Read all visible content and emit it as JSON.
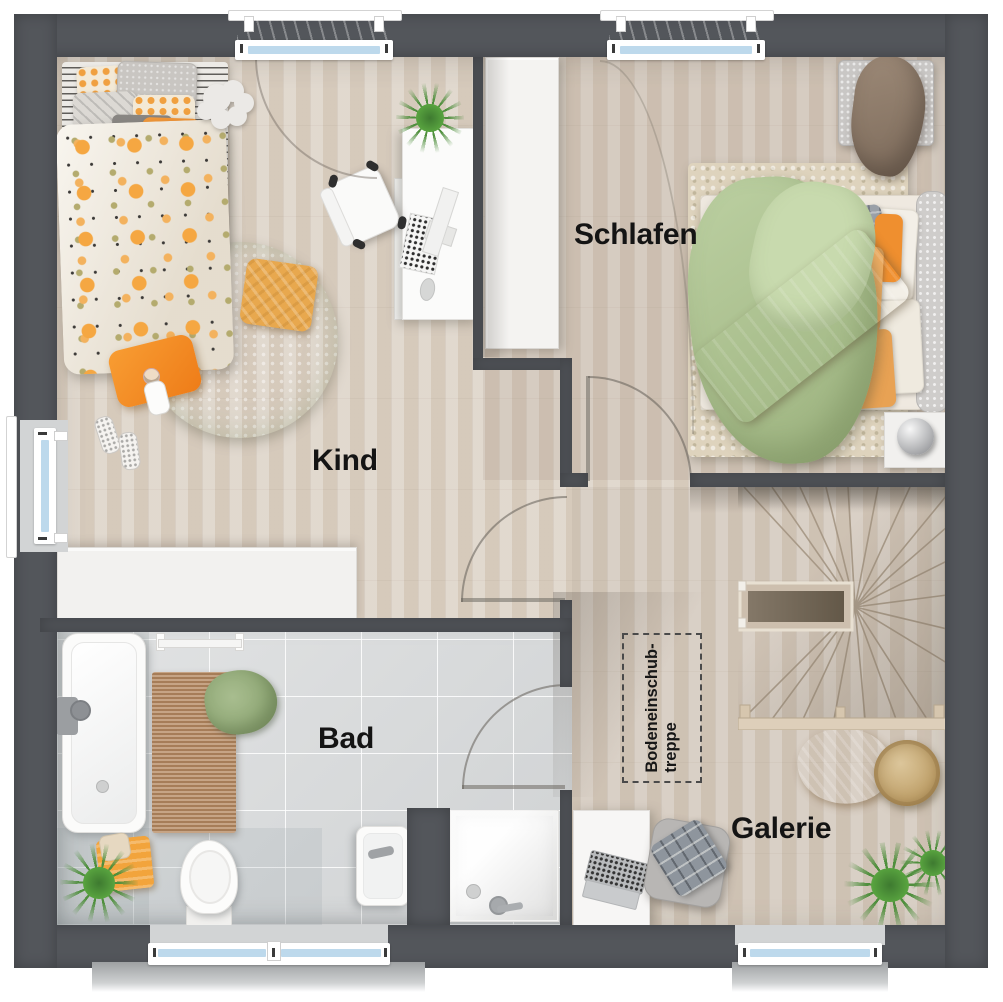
{
  "rooms": {
    "kind": {
      "label": "Kind"
    },
    "schlafen": {
      "label": "Schlafen"
    },
    "bad": {
      "label": "Bad"
    },
    "galerie": {
      "label": "Galerie"
    }
  },
  "attic_hatch": {
    "line1": "Bodeneinschub-",
    "line2": "treppe"
  },
  "colors": {
    "wall": "#53565b",
    "wood_floor": "#d9cec1",
    "tile_floor": "#d8dadb",
    "accent_orange": "#f09a3e",
    "accent_green": "#a8bf8d",
    "window_glass": "#bdd9ec"
  }
}
